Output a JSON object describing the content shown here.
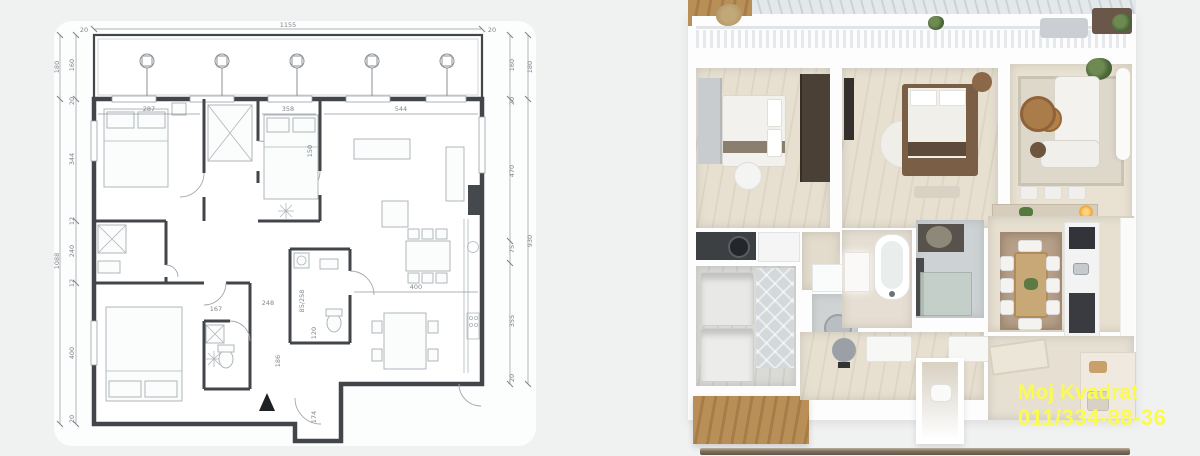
{
  "window": {
    "background": "#f0f1f1"
  },
  "floorplan": {
    "top_total": "1155",
    "corner": "20",
    "left_outer": [
      "180",
      "1088"
    ],
    "left_inner": [
      "160",
      "20",
      "344",
      "12",
      "240",
      "12",
      "400",
      "20"
    ],
    "right_outer": [
      "180",
      "930"
    ],
    "right_inner": [
      "160",
      "20",
      "470",
      "75",
      "355",
      "20"
    ],
    "interior": {
      "bedroom1": "287",
      "bedroom2": "358",
      "living": "544",
      "kitchen_wall": "400",
      "hall": "248",
      "wc": "167",
      "corridor": "150",
      "vestibule_width": "120",
      "vestibule_depth": "174",
      "hall_length": "186",
      "bathroom": "85/258"
    }
  },
  "watermark": {
    "line1": "Moj Kvadrat",
    "line2": "011/334-88-36",
    "color": "#fbfb4e"
  },
  "palette": {
    "plan_wall": "#42464a",
    "dimension_gray": "#8a8f94",
    "wood": "#b5894f",
    "plant_green": "#4e6b3f",
    "bottom_bar": "#7e705e",
    "watermark_yellow": "#fbfb4e"
  }
}
